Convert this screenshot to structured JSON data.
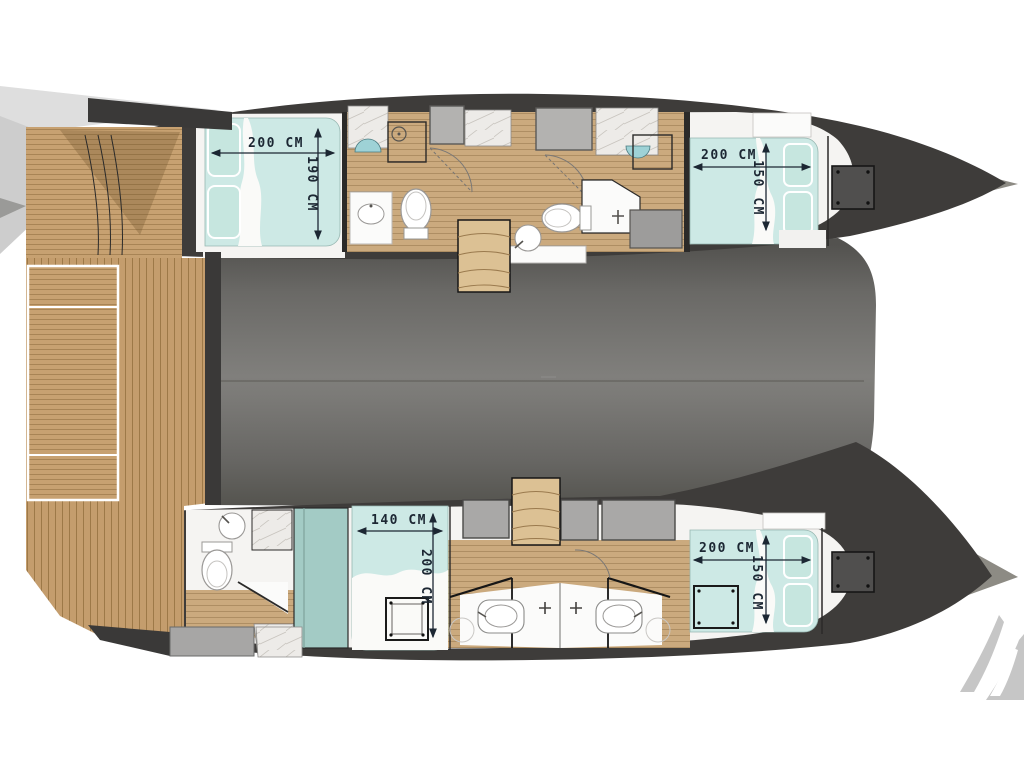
{
  "diagram": {
    "title": "Catamaran yacht floor plan (top view)",
    "orientation": "bow-right",
    "levels": "hull accommodation deck with cockpit aft and saloon bridgedeck"
  },
  "cabins": {
    "port_aft": {
      "label": "port aft owner cabin",
      "bed_width": "200 CM",
      "bed_length": "190 CM"
    },
    "port_forward": {
      "label": "port forward cabin",
      "bed_width": "200 CM",
      "bed_length": "150 CM"
    },
    "starboard_mid": {
      "label": "starboard mid cabin",
      "bed_width": "140 CM",
      "bed_length": "200 CM"
    },
    "starboard_forward": {
      "label": "starboard forward cabin",
      "bed_width": "200 CM",
      "bed_length": "150 CM"
    }
  },
  "features": {
    "bathrooms": "4 heads with toilet, washbasin and shower",
    "staircases": "2 companionway stairs from bridgedeck into hulls",
    "hatches": "bow deck hatches and escape hatches",
    "cockpit": "aft teak cockpit with side bench and swim step"
  },
  "colors": {
    "bed_teal": "#cde9e5",
    "pillow_teal": "#c6e6df",
    "wardrobe_teal": "#a3cbc5",
    "wood": "#c7a171",
    "stair_wood": "#dcc194",
    "hull_dark": "#3e3c3a",
    "saloon_gray": "#787774",
    "hatch_gray": "#b3b2b0",
    "marble": "#edebe8",
    "dimension_text": "#1c2733",
    "logo_gray": "#c6c6c6"
  }
}
